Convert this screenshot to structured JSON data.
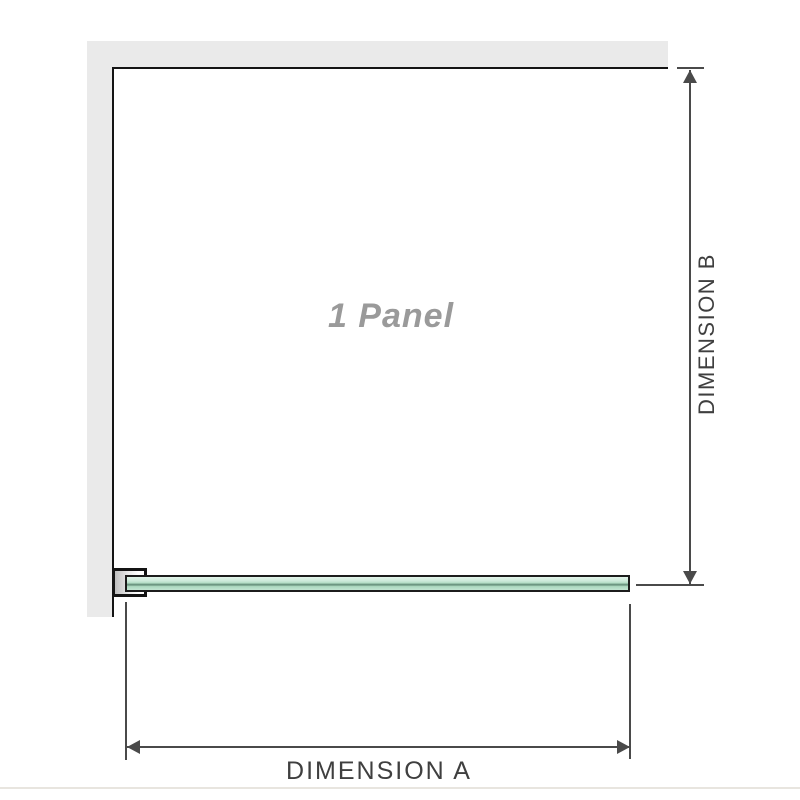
{
  "diagram": {
    "panel_label": "1 Panel",
    "dimension_a_label": "DIMENSION A",
    "dimension_b_label": "DIMENSION B",
    "colors": {
      "wall": "#eaeaea",
      "outline": "#141414",
      "dimension": "#4a4a4a",
      "dimension_text": "#3f3f3f",
      "panel_text": "#9a9a9a",
      "glass_green": "#b3ddc5"
    }
  }
}
